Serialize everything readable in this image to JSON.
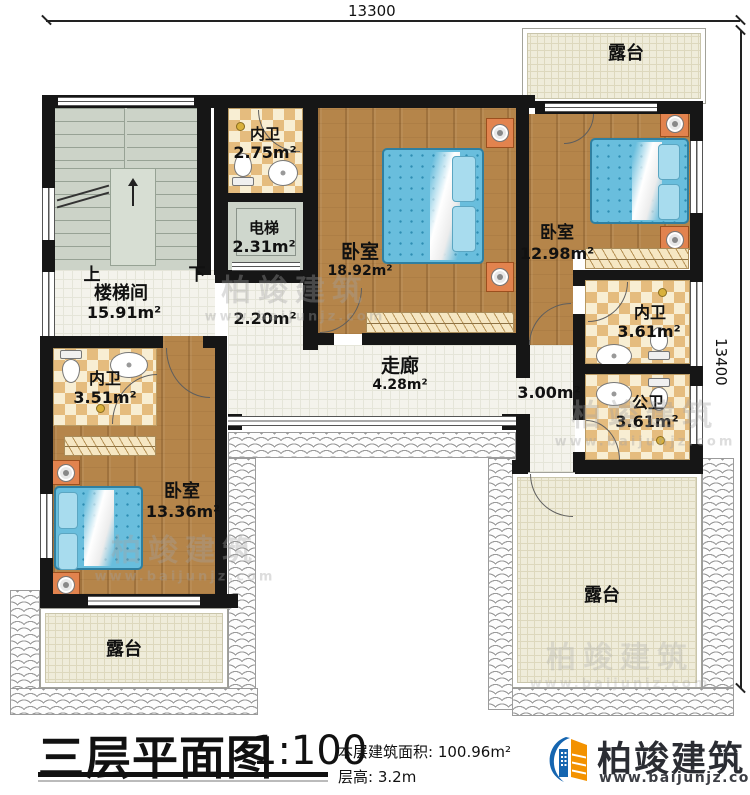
{
  "dimensions": {
    "top": "13300",
    "right": "13400"
  },
  "rooms": {
    "terrace_tr": {
      "name": "露台"
    },
    "terrace_bl": {
      "name": "露台"
    },
    "terrace_br": {
      "name": "露台"
    },
    "stairwell": {
      "name": "楼梯间",
      "area": "15.91m²",
      "up": "上",
      "down": "下"
    },
    "bath_top": {
      "name": "内卫",
      "area": "2.75m²"
    },
    "elevator": {
      "name": "电梯",
      "area": "2.31m²"
    },
    "bedroom_master": {
      "name": "卧室",
      "area": "18.92m²"
    },
    "bedroom_right": {
      "name": "卧室",
      "area": "12.98m²"
    },
    "bath_right": {
      "name": "内卫",
      "area": "3.61m²"
    },
    "bath_public": {
      "name": "公卫",
      "area": "3.61m²"
    },
    "bath_left": {
      "name": "内卫",
      "area": "3.51m²"
    },
    "bedroom_left": {
      "name": "卧室",
      "area": "13.36m²"
    },
    "corridor": {
      "name": "走廊",
      "area": "4.28m²"
    },
    "hall_elevator": {
      "area": "2.20m²"
    },
    "hall_right": {
      "area": "3.00m²"
    }
  },
  "footer": {
    "title": "三层平面图",
    "scale": "1:100",
    "area_label": "本层建筑面积:",
    "area_value": "100.96m²",
    "height_label": "层高:",
    "height_value": "3.2m"
  },
  "brand": {
    "name": "柏竣建筑",
    "url": "www.baijunjz.com"
  },
  "watermark": {
    "name": "柏竣建筑",
    "url": "www.baijunjz.com"
  },
  "colors": {
    "wall": "#161616",
    "wood": "#b5854a",
    "checker": "#e5bc7e",
    "tile": "#f4f3ec",
    "terrace": "#efecda",
    "bed": "#66bcdc",
    "nightstand": "#e2834e",
    "brand_blue": "#1565b0",
    "brand_orange": "#f39200"
  }
}
